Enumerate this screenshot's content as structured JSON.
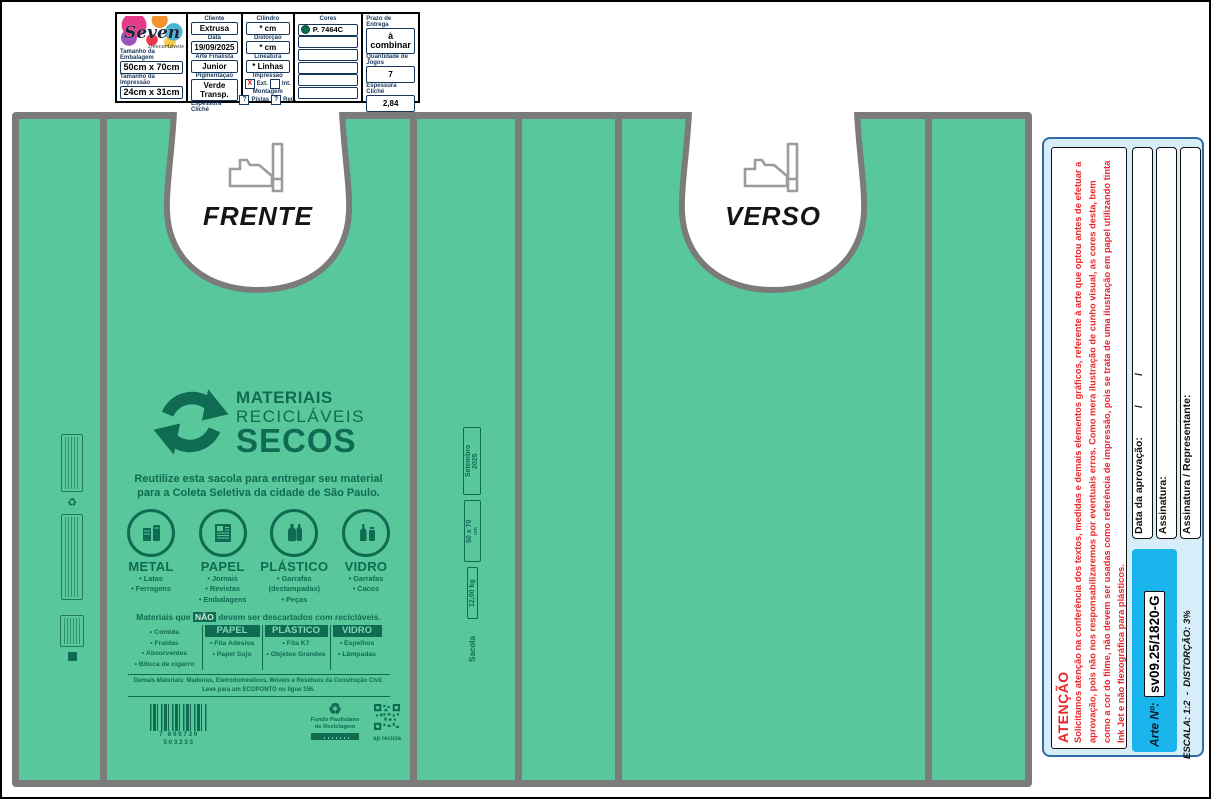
{
  "colors": {
    "bag_green": "#58C79C",
    "print_green": "#0F6B52",
    "outline_gray": "#7B7B7B",
    "panel_blue_bg": "#D7EDF9",
    "cyan": "#19B5EC",
    "alert_red": "#E9262C",
    "pantone_swatch": "#0B6B4F"
  },
  "header_form": {
    "logo": {
      "brand": "Seven",
      "sub": "Descartáveis"
    },
    "size_fields": [
      {
        "label": "Tamanho da Embalagem",
        "value": "50cm x 70cm"
      },
      {
        "label": "Tamanho da Impressão",
        "value": "24cm x 31cm"
      }
    ],
    "client_col": [
      {
        "label": "Cliente",
        "value": "Extrusa"
      },
      {
        "label": "Data",
        "value": "19/09/2025"
      },
      {
        "label": "Arte Finalista",
        "value": "Junior"
      },
      {
        "label": "Pigmentação",
        "value": "Verde Transp."
      },
      {
        "label": "Espessura Cliché",
        "value": "2,84"
      }
    ],
    "print_col": {
      "fields": [
        {
          "label": "Cilindro",
          "value": "* cm"
        },
        {
          "label": "Distorção",
          "value": "* cm"
        },
        {
          "label": "Lineatura",
          "value": "* Linhas"
        }
      ],
      "impressao": {
        "label": "Impressão",
        "check1": "X",
        "opt1": "Ext.",
        "check2": "",
        "opt2": "Int."
      },
      "montagem": {
        "label": "Montagem",
        "check1": "?",
        "opt1": "Pistas",
        "check2": "?",
        "opt2": "Rep."
      }
    },
    "colors_col": {
      "label": "Cores",
      "value": "P. 7464C"
    },
    "delivery_col": [
      {
        "label": "Prazo de Entrega",
        "value": "à combinar"
      },
      {
        "label": "Quantidade de Jogos",
        "value": "7"
      },
      {
        "label": "Espessura Cliché",
        "value": "2,84"
      }
    ]
  },
  "bag": {
    "front_label": "FRENTE",
    "back_label": "VERSO",
    "gusset_labels": {
      "month": "Setembro",
      "year": "2025",
      "dimensions": "50 x 70",
      "dim_unit": "cm",
      "capacity": "12,00 kg",
      "bag_word": "Sacola"
    },
    "artwork": {
      "title_line1": "MATERIAIS",
      "title_line2": "RECICLÁVEIS",
      "title_line3": "SECOS",
      "tagline_line1": "Reutilize esta sacola para entregar seu material",
      "tagline_line2": "para a Coleta Seletiva da cidade de São Paulo.",
      "categories": [
        {
          "name": "METAL",
          "item0": "• Latas",
          "item1": "• Ferragens",
          "item2": ""
        },
        {
          "name": "PAPEL",
          "item0": "• Jornais",
          "item1": "• Revistas",
          "item2": "• Embalagens"
        },
        {
          "name": "PLÁSTICO",
          "item0": "• Garrafas",
          "item1": "(destampadas)",
          "item2": "• Peças"
        },
        {
          "name": "VIDRO",
          "item0": "• Garrafas",
          "item1": "• Cacos",
          "item2": ""
        }
      ],
      "forbidden_intro": {
        "pre": "Materiais que",
        "highlight": "NÃO",
        "post": "devem ser descartados com recicláveis."
      },
      "forbidden_table": {
        "general_items": [
          "• Comida",
          "• Fraldas",
          "• Absorventes",
          "• Bituca de cigarro"
        ],
        "papel": {
          "header": "PAPEL",
          "item0": "• Fita Adesiva",
          "item1": "• Papel Sujo"
        },
        "plastico": {
          "header": "PLÁSTICO",
          "item0": "• Fita K7",
          "item1": "• Objetos Grandes"
        },
        "vidro": {
          "header": "VIDRO",
          "item0": "• Espelhos",
          "item1": "• Lâmpadas"
        }
      },
      "footer_line1": "Demais Materiais: Madeiras, Eletrodomésticos, Móveis e Resíduos da Construção Civil.",
      "footer_line2": "Leve para um ECOPONTO ou ligue 156.",
      "barcode_digits": "7 899739 503233",
      "fund_logo_line1": "Fundo Paulistano",
      "fund_logo_line2": "de Reciclagem",
      "qr_caption": "sp recicla"
    }
  },
  "approval_panel": {
    "attention_title": "ATENÇÃO",
    "attention_body": "Solicitamos atenção na conferência dos textos, medidas e demais elementos gráficos, referente à arte que optou antes de efetuar a aprovação, pois não nos responsabilizaremos por eventuais erros. Como mera ilustração de cunho visual, as cores desta, bem como a cor do filme, não devem ser usadas como referência de impressão, pois se trata de uma ilustração em papel utilizando tinta Ink Jet e não flexográfica para plásticos.",
    "field_date": "Data da aprovação:          /          /",
    "field_signature": "Assinatura:",
    "field_rep": "Assinatura / Representante:",
    "art_no_label": "Arte Nº:",
    "art_no_value": "sv09.25/1820-G",
    "scale_note": "ESCALA: 1:2  -  DISTORÇÃO: 3%"
  }
}
